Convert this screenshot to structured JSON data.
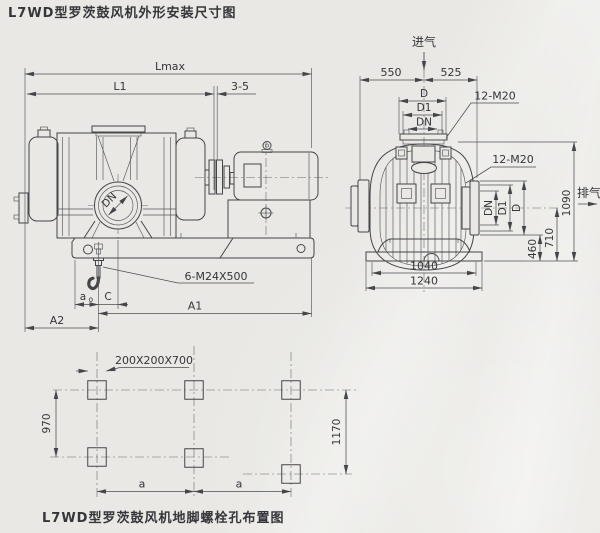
{
  "title": "L7WD型罗茨鼓风机外形安装尺寸图",
  "side_view": {
    "lmax": "Lmax",
    "l1": "L1",
    "gap": "3-5",
    "port_label": "DN",
    "bolt_label": "6-M24X500",
    "a0_main": "a",
    "a0_sub": "o",
    "c": "C",
    "a1": "A1",
    "a2": "A2"
  },
  "end_view": {
    "inlet": "进气",
    "outlet": "排气",
    "dim_550": "550",
    "dim_525": "525",
    "d": "D",
    "d1": "D1",
    "dn": "DN",
    "bolts_top": "12-M20",
    "bolts_side": "12-M20",
    "dn_v": "DN",
    "d1_v": "D1",
    "d_v": "D",
    "dim_460": "460",
    "dim_710": "710",
    "dim_1090": "1090",
    "dim_1040": "1040",
    "dim_1240": "1240"
  },
  "plan_view": {
    "pocket_label": "200X200X700",
    "dim_970": "970",
    "dim_1170": "1170",
    "a_left": "a",
    "a_right": "a"
  },
  "caption": "L7WD型罗茨鼓风机地脚螺栓孔布置图"
}
